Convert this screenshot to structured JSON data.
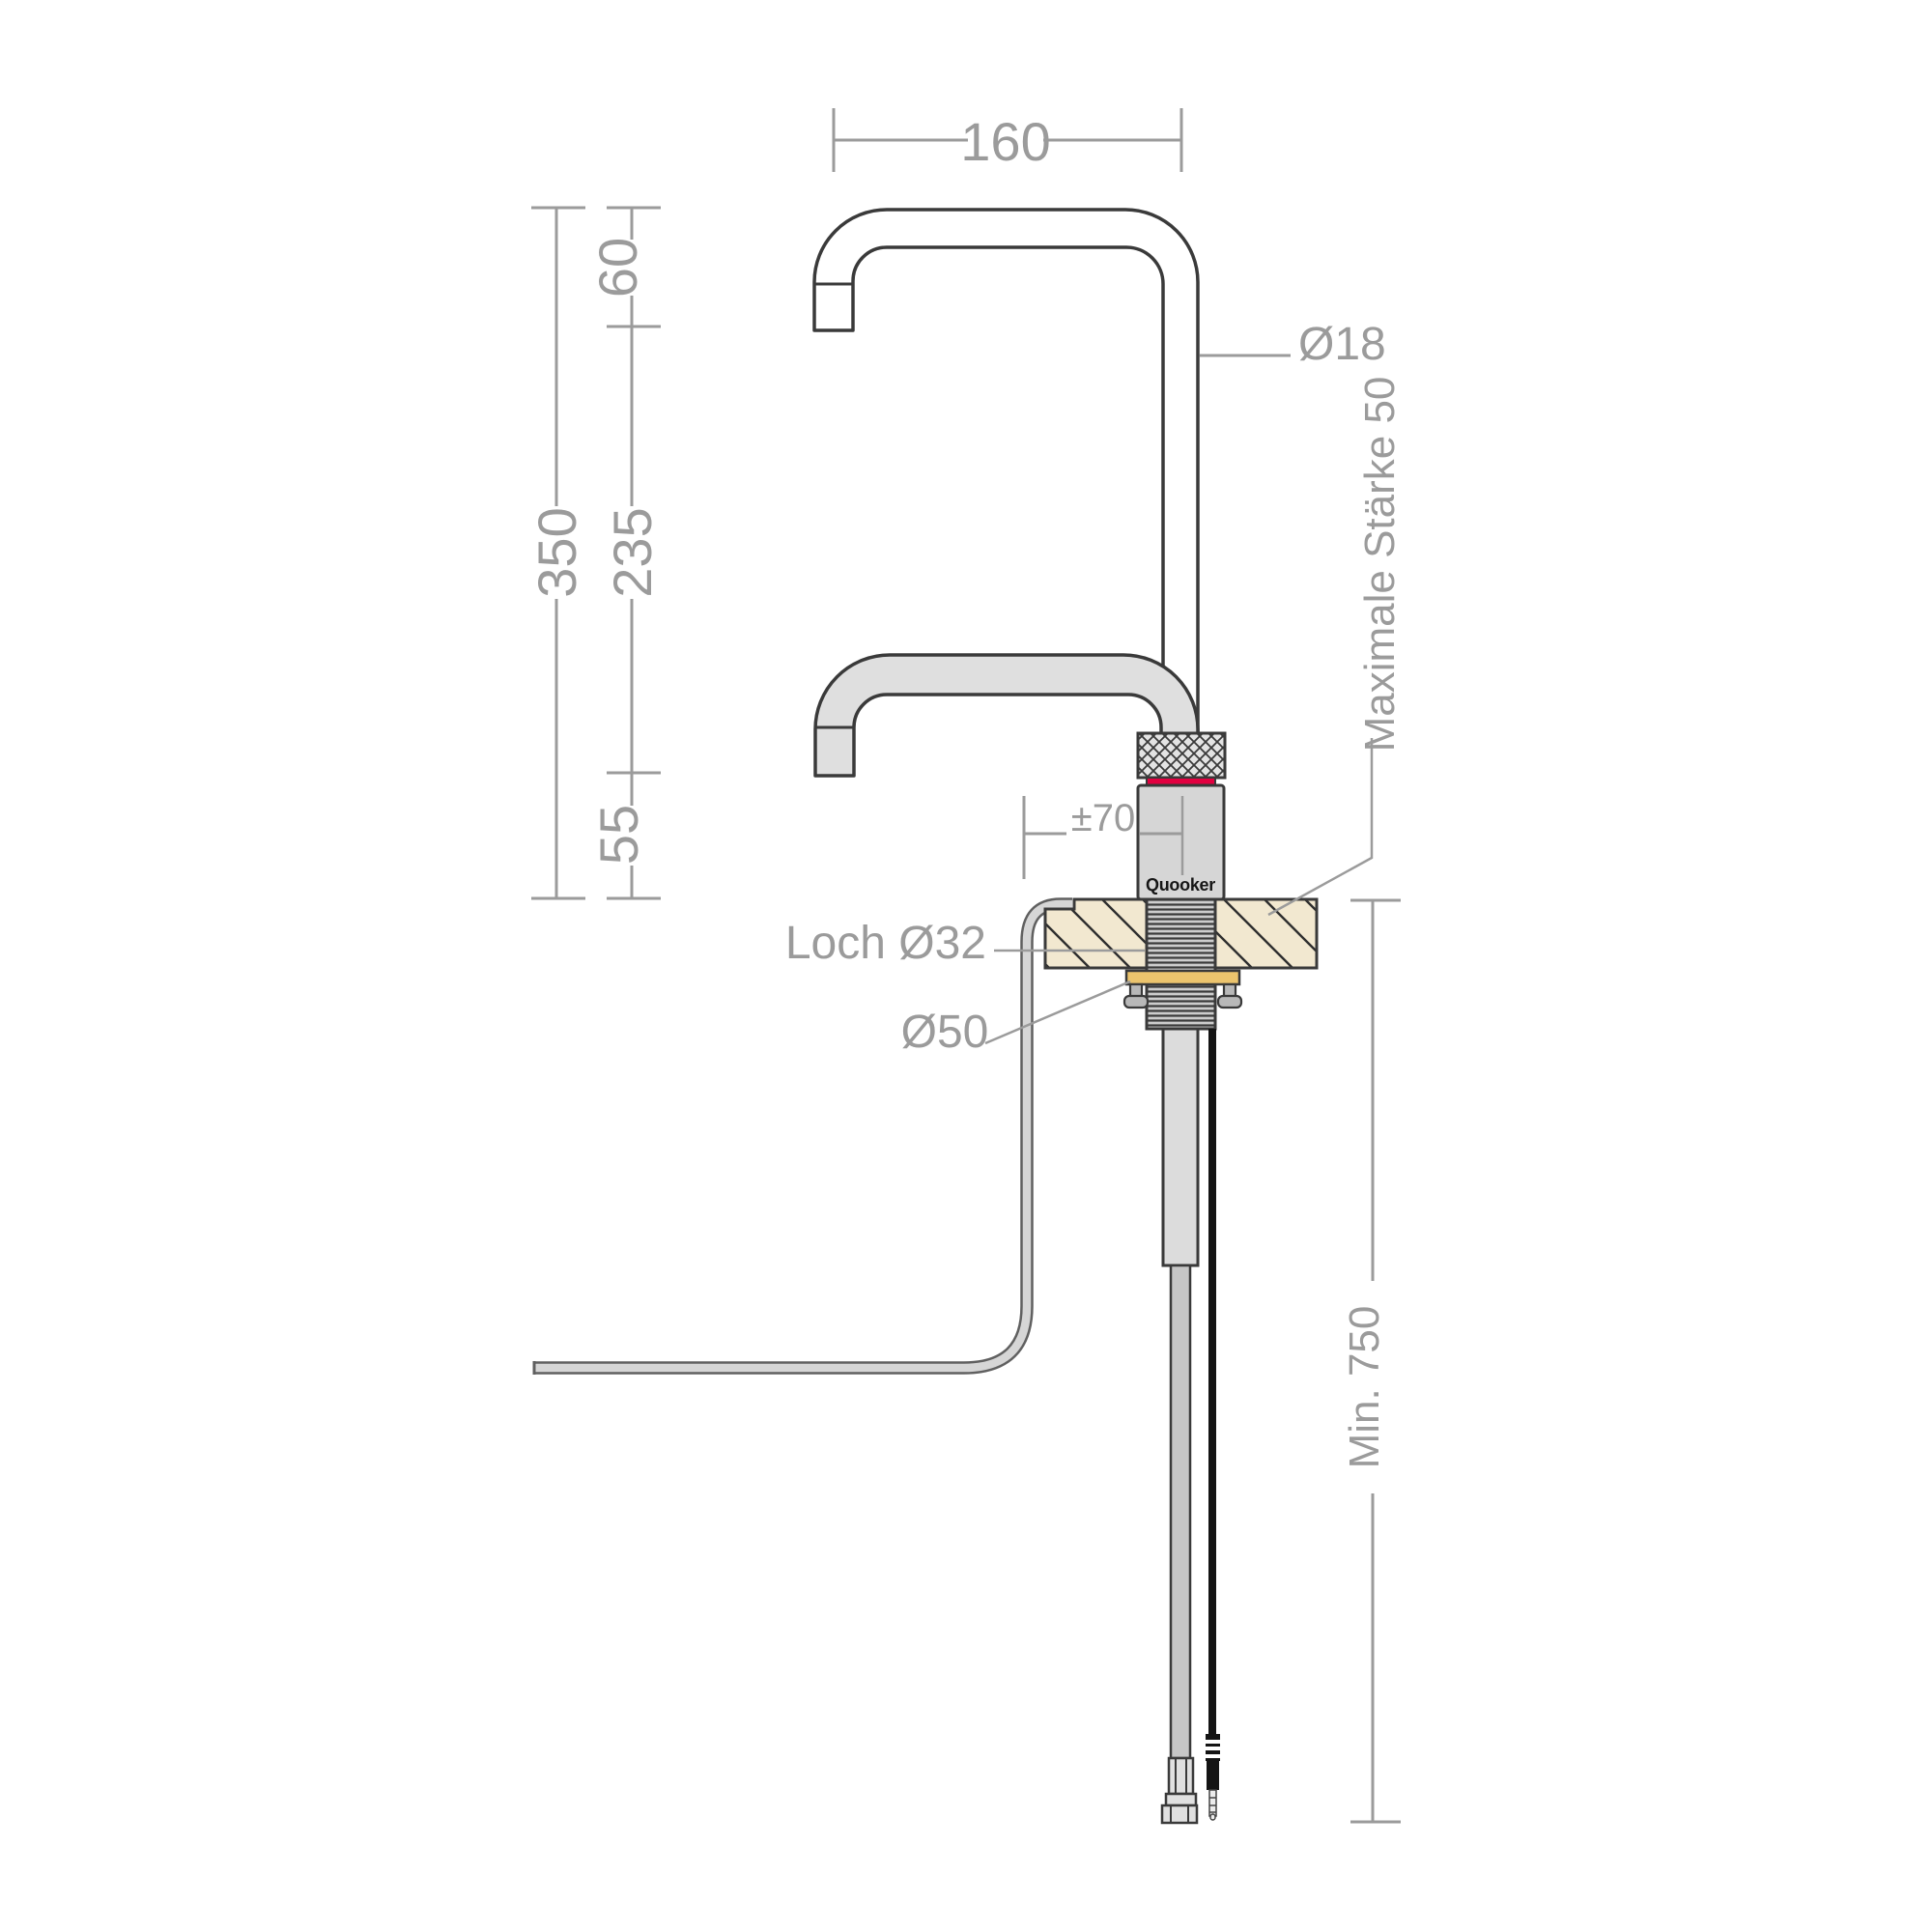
{
  "labels": {
    "reach": "160",
    "top_height": "60",
    "total_height": "350",
    "mid_height": "235",
    "base_height": "55",
    "spout_diameter": "Ø18",
    "max_thickness": "Maximale Stärke 50",
    "offset": "±70",
    "hole": "Loch Ø32",
    "washer": "Ø50",
    "min_depth": "Min. 750",
    "brand": "Quooker"
  },
  "colors": {
    "dimension_gray": "#9b9b9b",
    "outline_dark": "#3a3a3a",
    "spout_fill": "#dfdfdf",
    "body_gray": "#d6d6d6",
    "worktop_beige": "#f2e8d0",
    "brass": "#ecc46d",
    "accent_red": "#e30040",
    "hose_gray": "#c6c6c6",
    "cable_black": "#141414"
  }
}
